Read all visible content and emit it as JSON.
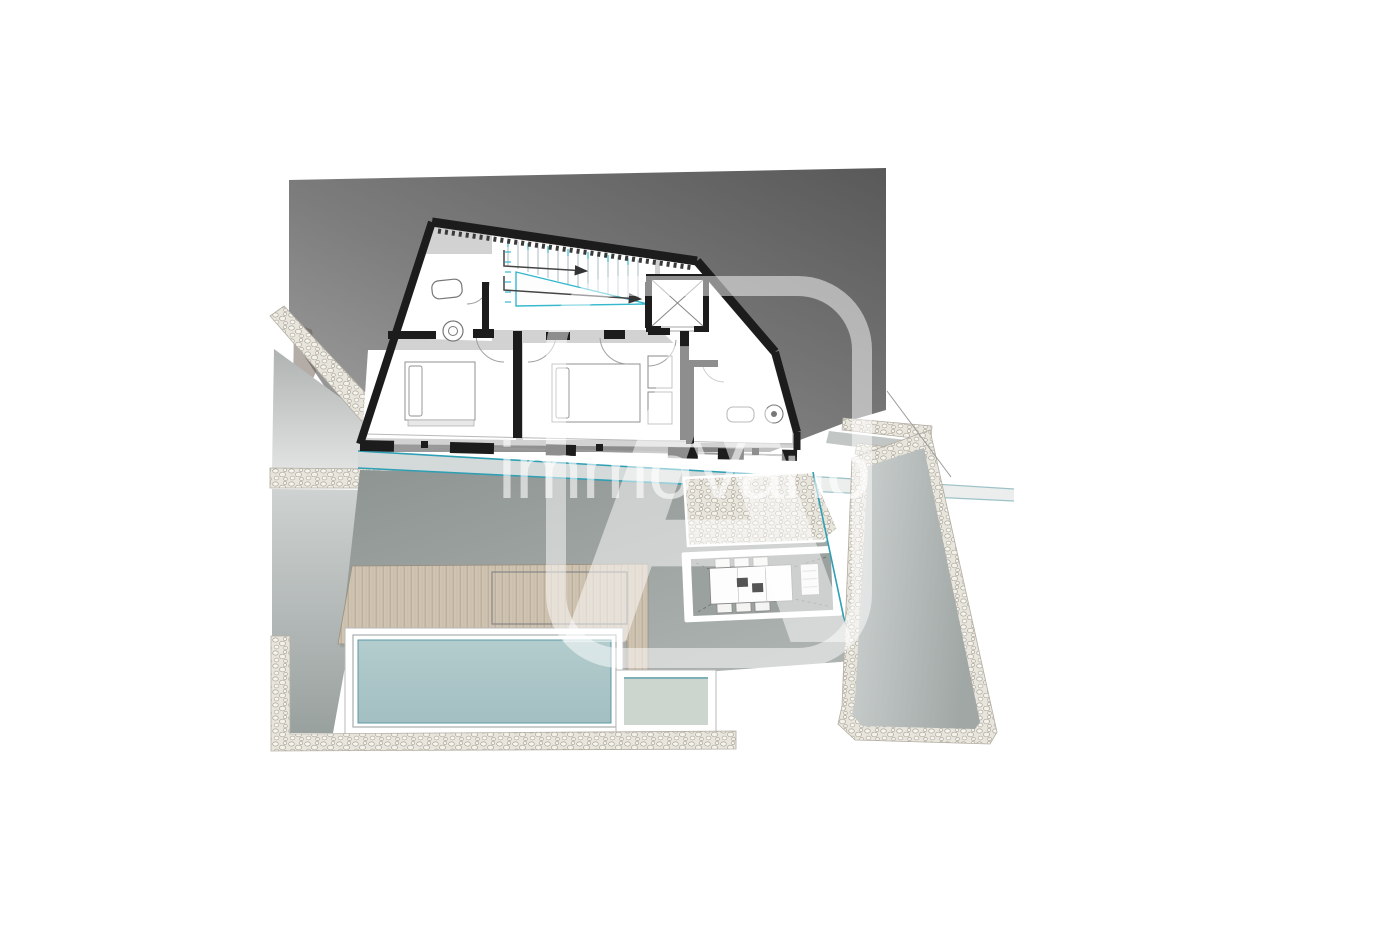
{
  "watermark": {
    "brand_text": "immoVario",
    "logo_letter": "A"
  },
  "plan": {
    "features": [
      "hillside",
      "gravel-path-upper",
      "gravel-path-mid",
      "driveway-wedge",
      "side-strip-left",
      "building-outline",
      "bathroom-top-left",
      "staircase",
      "elevator",
      "bedroom-left",
      "bedroom-middle",
      "bathroom-right",
      "water-feature-band",
      "terrace",
      "wooden-deck",
      "deck-opening-outline",
      "swimming-pool",
      "pool-shelf",
      "courtyard-gravel",
      "sunken-patio",
      "dining-table",
      "garden-bench",
      "walkway-right",
      "boundary-line",
      "bottom-gravel-border"
    ]
  },
  "colors": {
    "background": "#ffffff",
    "hillside_dark": "#595959",
    "hillside_light": "#a3a3a3",
    "wall_black": "#1c1c1c",
    "floor_gray": "#d2d2d2",
    "accent_teal": "#2f9fb4",
    "stair_teal": "#35b8cc",
    "terrace_gray": "#98a09e",
    "deck_wood": "#cfc3b2",
    "pool_water": "#aac5c8",
    "pool_shelf": "#ccd6cf",
    "gravel": "#e8e5dd",
    "watermark_white": "#ffffff"
  }
}
